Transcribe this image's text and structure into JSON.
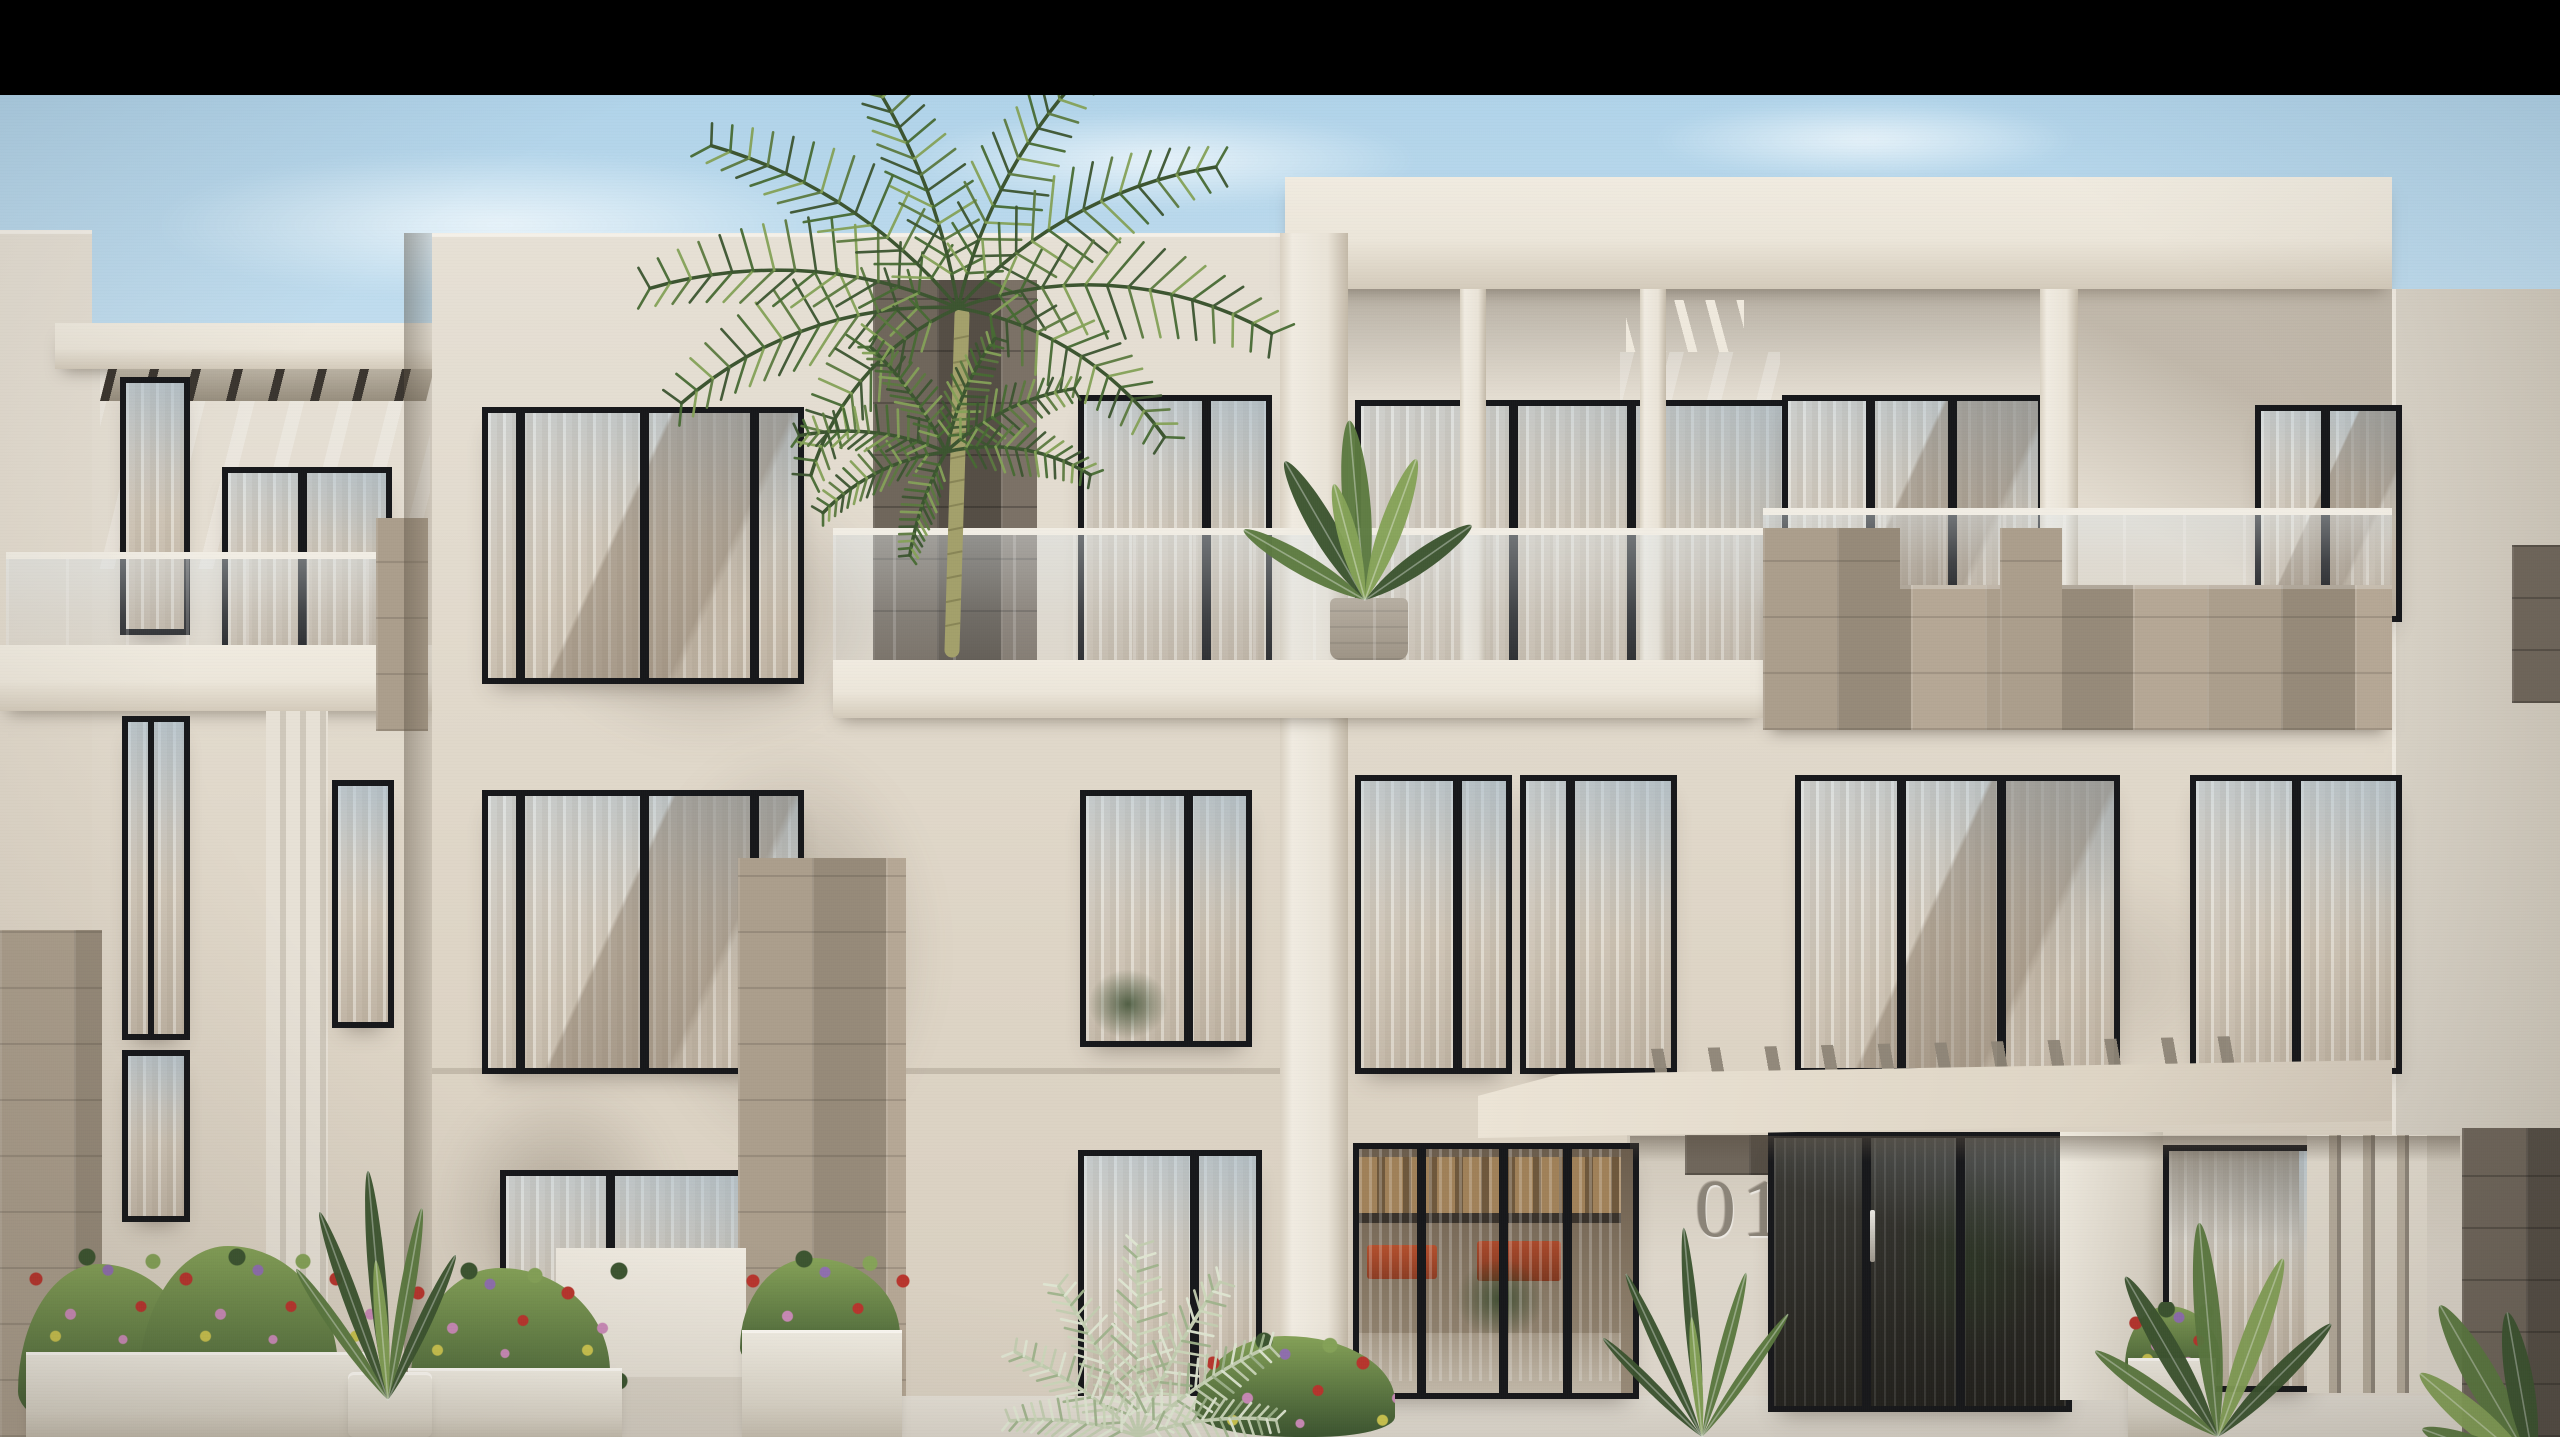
{
  "scene": {
    "kind": "architectural-exterior-rendering",
    "subject": "modern three-storey white apartment building with stone accents, balconies and palm trees",
    "letterbox": {
      "position": "top",
      "color": "#000000"
    },
    "sign": {
      "text": "01"
    },
    "features": {
      "floors_visible": 3,
      "palm_trees": 2,
      "balcony_railings": "frameless glass with light handrail",
      "window_frames": "slim dark aluminium",
      "accents": "travertine stone cladding piers and parapets",
      "entrance": "covered canopy with pergola beams, unit number 01, dark glazed doors",
      "landscaping": "white planter boxes with red, pink and purple flowers, banana plants, strelitzia"
    },
    "palette": {
      "black": "#000000",
      "sky_top": "#a9cfe7",
      "sky_mid": "#c6e0f0",
      "sky_low": "#ddeef7",
      "cloud": "#f4fafd",
      "wall": "#e6e0d5",
      "wall_warm": "#ded5c6",
      "wall_shadow": "#c7bcab",
      "wall_deep": "#a89d8d",
      "band": "#ece6da",
      "soffit": "#8e8577",
      "frame": "#17181b",
      "glass_sky": "#b9c8d2",
      "curtain": "#d7ccbe",
      "curtain_lt": "#efe9df",
      "refl_brown": "#8d7c69",
      "stone_lt": "#ab9e8c",
      "stone_md": "#968a79",
      "stone_dk": "#6f665b",
      "stone_darker": "#554e45",
      "rail": "#f1ede4",
      "green_dk": "#3c5530",
      "green_md": "#5c7a40",
      "green_lt": "#85a258",
      "green_pale": "#c2cdb0",
      "flower_red": "#b8352d",
      "flower_pink": "#c98ab6",
      "flower_purple": "#8f6fae",
      "flower_yellow": "#c9c24e",
      "trunk": "#a3a06b",
      "pavement": "#d9d3c8",
      "sign": "#8b8478",
      "canopy": "#e9e2d4",
      "interior_dark": "#2b2925",
      "interior_warm": "#7c6a54",
      "wood": "#a8865a"
    }
  }
}
